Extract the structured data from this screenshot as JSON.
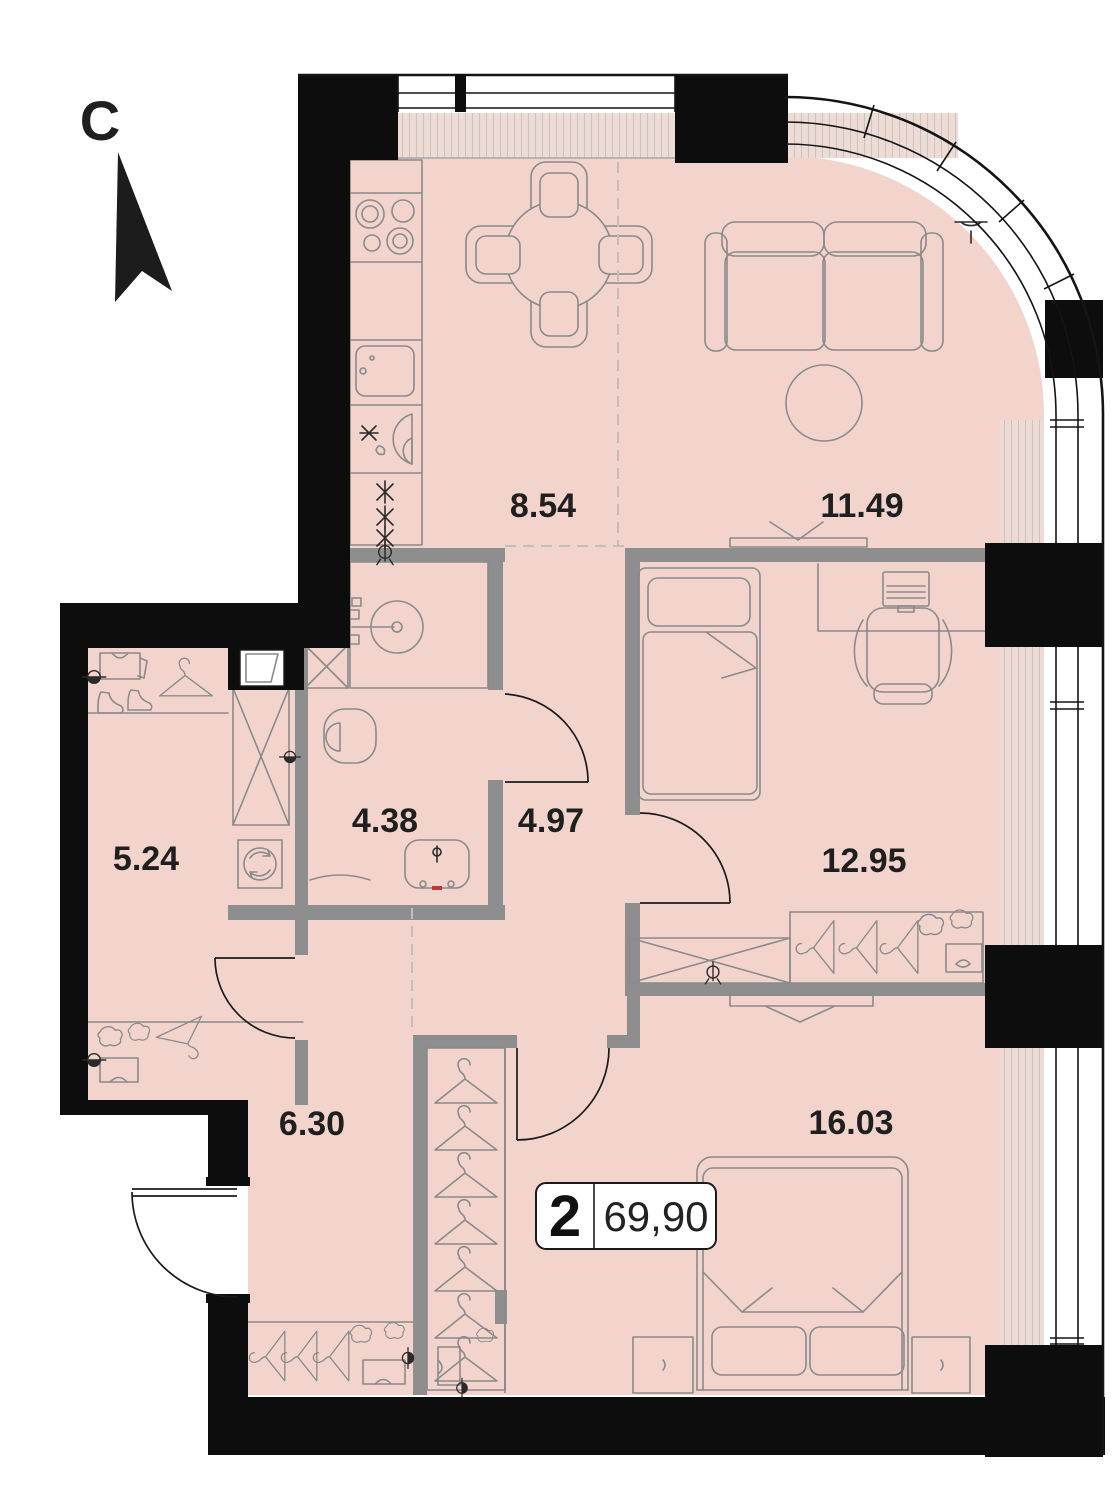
{
  "plan": {
    "north_label": "С",
    "badge": {
      "rooms_count": "2",
      "total_area": "69,90"
    },
    "rooms": [
      {
        "name": "kitchen-zone",
        "area": "8.54"
      },
      {
        "name": "living-zone",
        "area": "11.49"
      },
      {
        "name": "wardrobe-room",
        "area": "5.24"
      },
      {
        "name": "bathroom",
        "area": "4.38"
      },
      {
        "name": "hallway",
        "area": "4.97"
      },
      {
        "name": "bedroom",
        "area": "12.95"
      },
      {
        "name": "corridor",
        "area": "6.30"
      },
      {
        "name": "master-bedroom",
        "area": "16.03"
      }
    ],
    "colors": {
      "floor": "#f3d4cd",
      "wall_black": "#0d0d0d",
      "wall_gray": "#8e8e8e",
      "furniture_line": "#8a8a8a",
      "accent_red": "#c0392b"
    },
    "icons": [
      "north-arrow-icon",
      "stove-icon",
      "kitchen-sink-icon",
      "dining-table-icon",
      "sofa-icon",
      "coffee-table-icon",
      "tv-icon",
      "shower-icon",
      "toilet-icon",
      "washbasin-icon",
      "washing-machine-icon",
      "single-bed-icon",
      "double-bed-icon",
      "desk-icon",
      "laptop-icon",
      "office-chair-icon",
      "wardrobe-icon",
      "hanger-icon",
      "boots-icon",
      "clothes-icon"
    ]
  }
}
